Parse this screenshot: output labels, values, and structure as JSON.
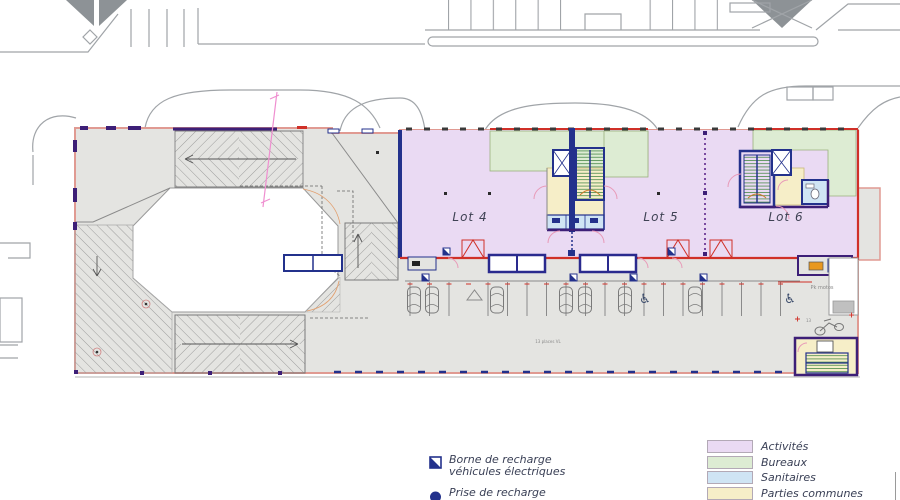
{
  "plan": {
    "lots": [
      {
        "label": "Lot 4"
      },
      {
        "label": "Lot 5"
      },
      {
        "label": "Lot 6"
      }
    ],
    "annotations": {
      "parking_places": "13 places VL",
      "moto_parking": "Pk motos",
      "moto_count": "13"
    }
  },
  "legend": {
    "symbols": [
      {
        "line1": "Borne de recharge",
        "line2": "véhicules électriques"
      },
      {
        "line1": "Prise de recharge",
        "line2": ""
      }
    ],
    "zones": [
      {
        "label": "Activités",
        "color": "#eadaf3"
      },
      {
        "label": "Bureaux",
        "color": "#ddecd3"
      },
      {
        "label": "Sanitaires",
        "color": "#cfe4f4"
      },
      {
        "label": "Parties communes",
        "color": "#f6eec8"
      }
    ]
  },
  "colors": {
    "activites": "#eadaf3",
    "bureaux": "#ddecd3",
    "sanitaires": "#cfe4f4",
    "parties_communes": "#f6eec8",
    "facade_pink": "#e09a92",
    "wall_dark_purple": "#3d1f77",
    "wall_blue": "#23318c",
    "separation_red": "#d03028",
    "stair_green": "#4a8a4a"
  }
}
